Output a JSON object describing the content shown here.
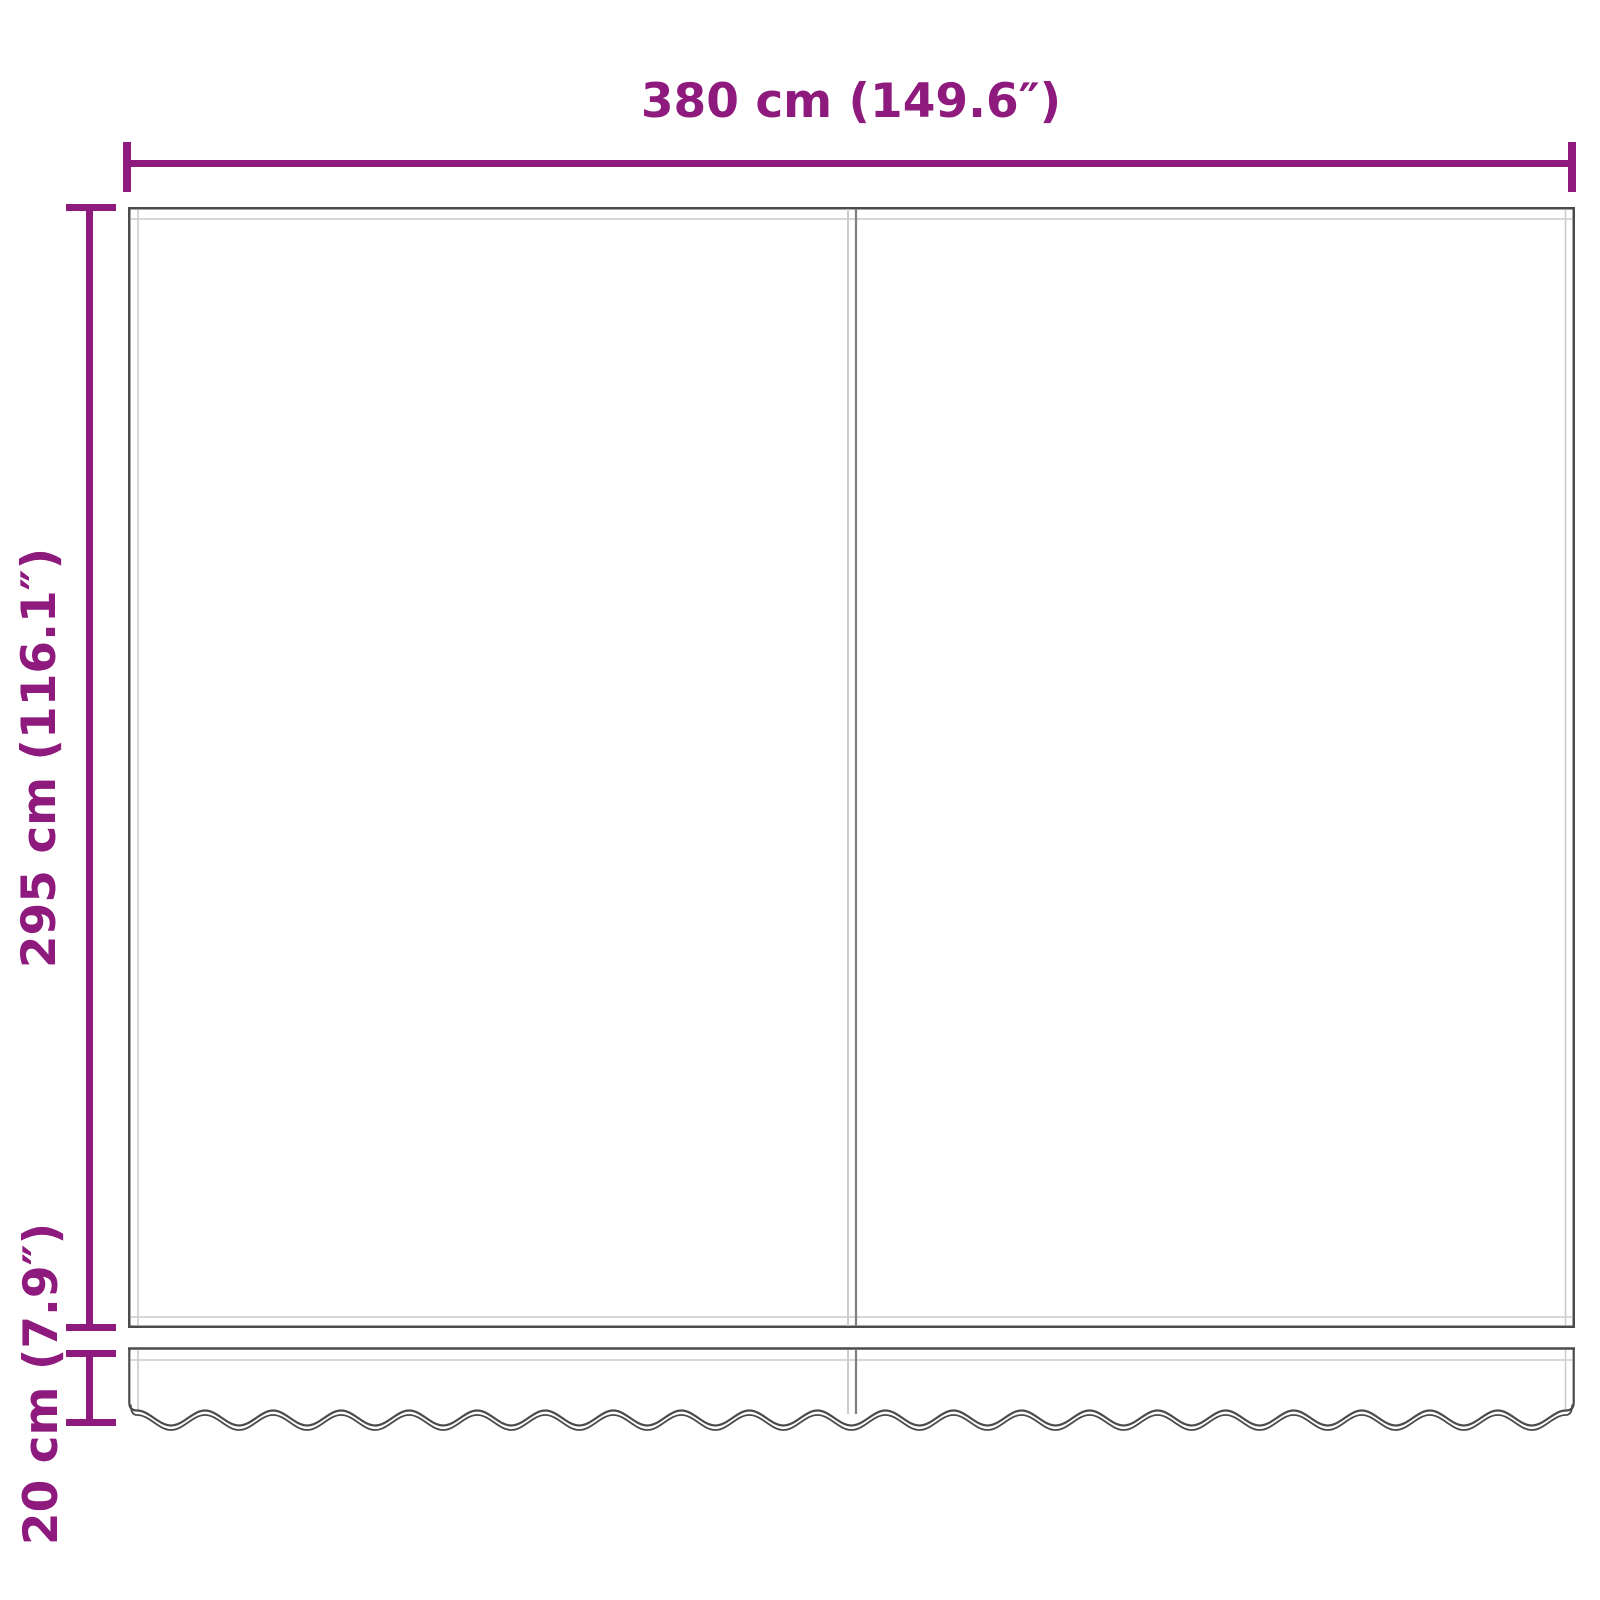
{
  "diagram": {
    "dimensions": {
      "width": {
        "label": "380 cm (149.6″)",
        "cm": 380,
        "inches": 149.6
      },
      "height": {
        "label": "295 cm (116.1″)",
        "cm": 295,
        "inches": 116.1
      },
      "valance": {
        "label": "20 cm (7.9″)",
        "cm": 20,
        "inches": 7.9
      }
    },
    "colors": {
      "dimension_accent": "#8e1a7d",
      "outline": "#4b4b4b",
      "seam_light": "#cccccc",
      "seam_dark": "#7f7f7f",
      "background": "#ffffff"
    }
  }
}
